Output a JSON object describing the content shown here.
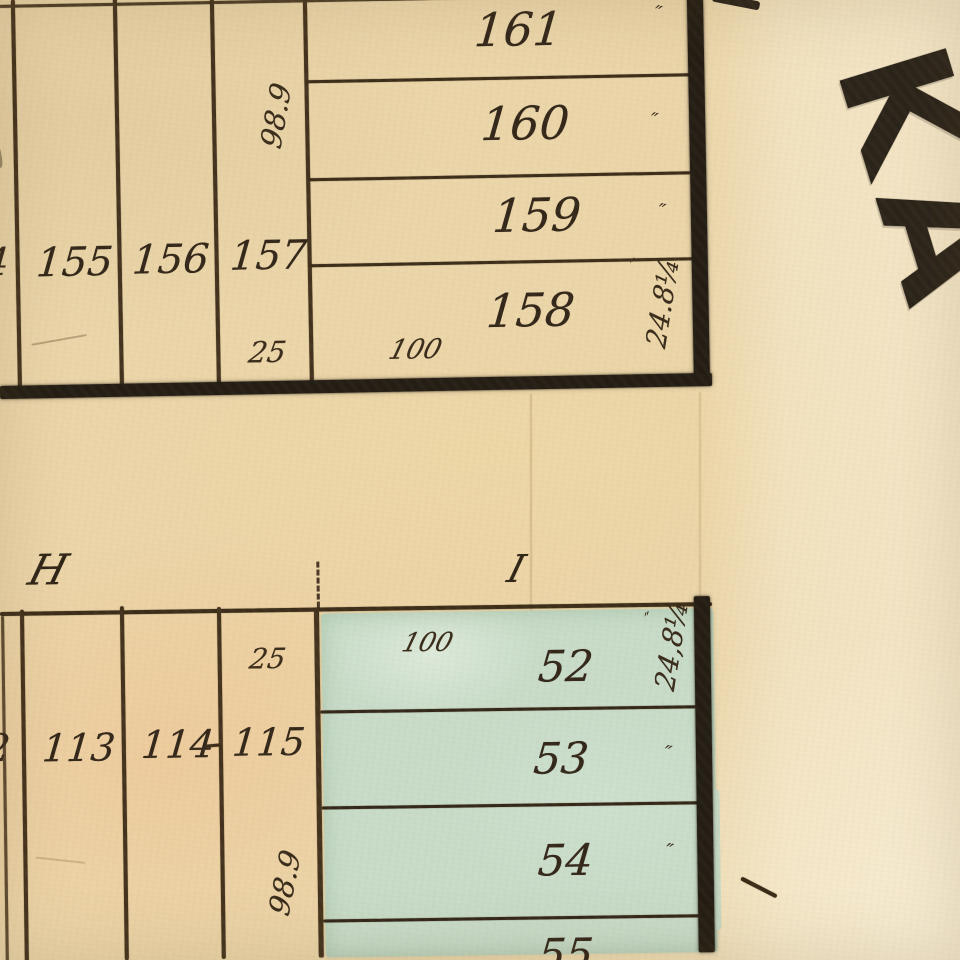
{
  "map": {
    "description": "antique plat map scan",
    "street_letters": "KA",
    "ditto_mark": "″",
    "top_block": {
      "left_partial_lot": "4",
      "column_lots": [
        "155",
        "156",
        "157"
      ],
      "front_width": "25",
      "side_depth": "98.9",
      "row_length": "100",
      "east_width": "24.8¼",
      "row_lots": [
        "161",
        "160",
        "159",
        "158"
      ]
    },
    "bottom_blocks": {
      "label_left": "H",
      "label_right": "I",
      "h_block": {
        "left_partial_lot": "2",
        "column_lots": [
          "113",
          "114",
          "115"
        ],
        "front_width": "25",
        "side_depth": "98.9"
      },
      "i_block": {
        "row_length": "100",
        "east_width": "24,8¼",
        "row_lots": [
          "52",
          "53",
          "54",
          "55"
        ]
      }
    }
  },
  "colors": {
    "paper": "#ebd6aa",
    "paper_pink": "#f3b87a",
    "paper_light": "#faf1da",
    "teal_wash": "#c8dcc9",
    "ink_line": "#43321d",
    "ink_thick": "#241d14",
    "ink_text": "#33271a",
    "street_ink": "#2b241a"
  }
}
